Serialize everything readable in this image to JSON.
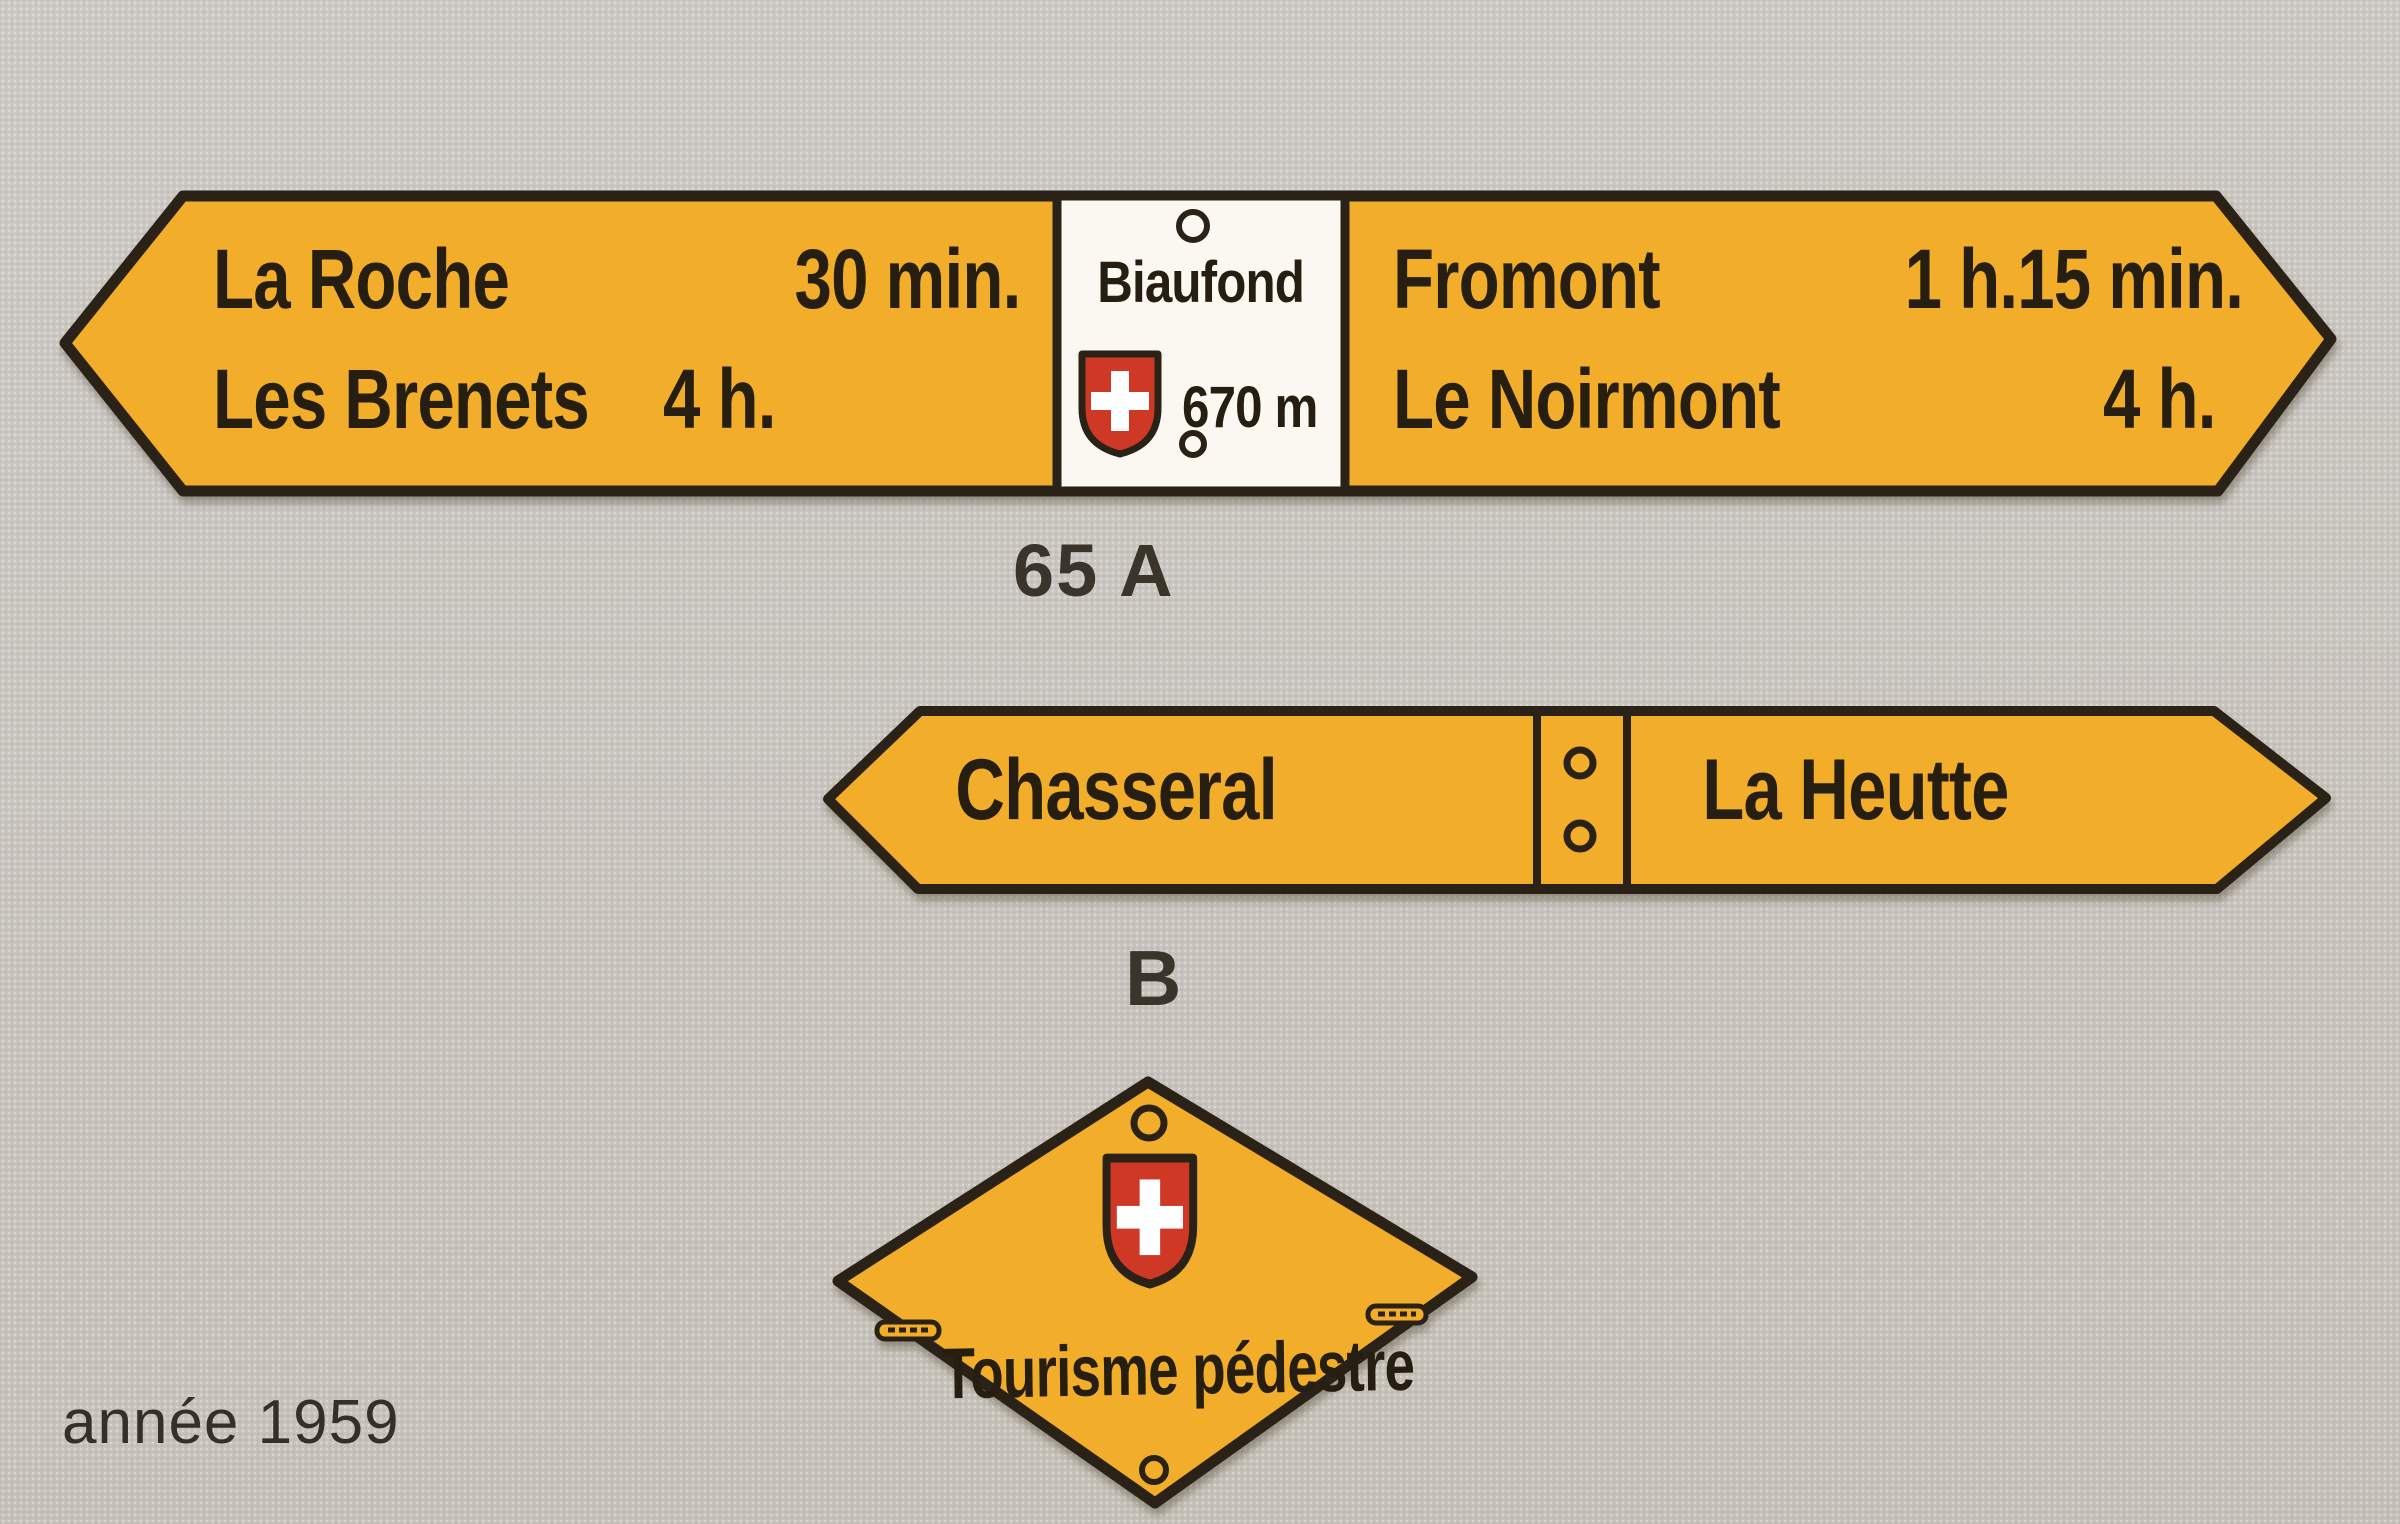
{
  "caption": {
    "text": "année 1959"
  },
  "colors": {
    "background_gray": "#c9c5bf",
    "sign_yellow": "#f2ae2b",
    "sign_outline": "#2b2318",
    "panel_white": "#faf8f1",
    "shield_red": "#d03927",
    "shield_cross_white": "#ffffff",
    "sign_text_dark": "#261e10"
  },
  "sign_a": {
    "id_label": "65 A",
    "panel": {
      "place": "Biaufond",
      "elevation": "670 m",
      "emblem": "swiss-shield"
    },
    "left_arrow": {
      "direction": "left",
      "rows": [
        {
          "destination": "La Roche",
          "time": "30 min."
        },
        {
          "destination": "Les Brenets",
          "time": "4 h."
        }
      ]
    },
    "right_arrow": {
      "direction": "right",
      "rows": [
        {
          "destination": "Fromont",
          "time": "1 h.15 min."
        },
        {
          "destination": "Le Noirmont",
          "time": "4 h."
        }
      ]
    }
  },
  "sign_b": {
    "id_label": "B",
    "left_arrow": {
      "direction": "left",
      "destination": "Chasseral"
    },
    "right_arrow": {
      "direction": "right",
      "destination": "La Heutte"
    }
  },
  "sign_c": {
    "text": "Tourisme pédestre",
    "emblem": "swiss-shield"
  }
}
